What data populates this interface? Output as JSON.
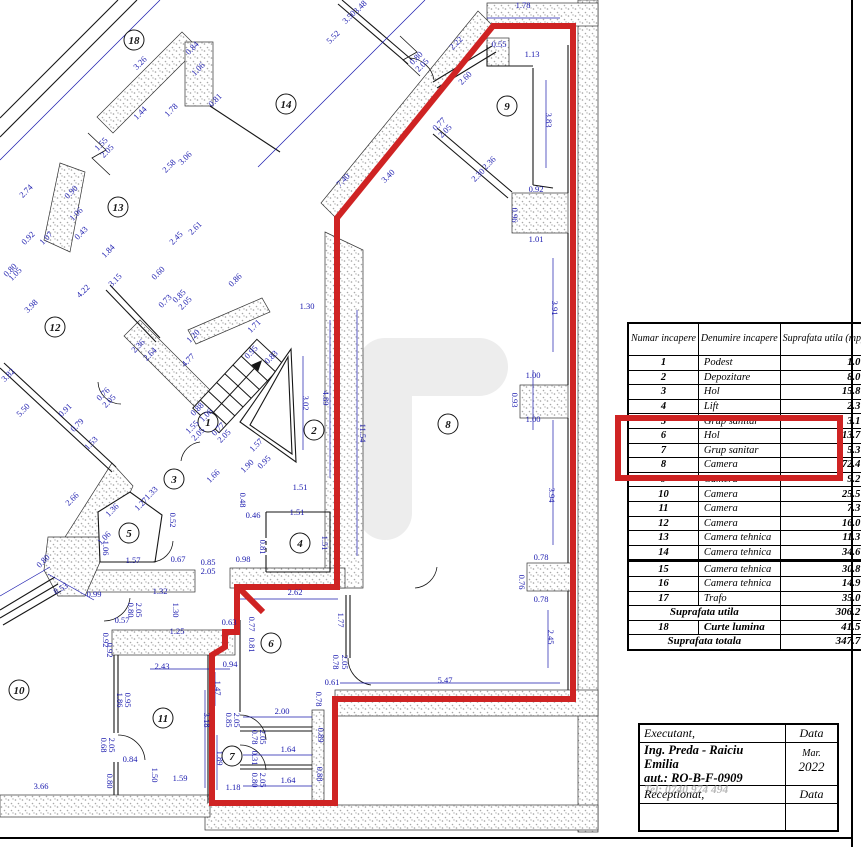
{
  "colors": {
    "dim_blue": "#1a1aae",
    "highlight_red": "#cf2323",
    "wall_line": "#161616",
    "stipple_gray": "#9f9f9f",
    "tel_gray": "#b8b8b8"
  },
  "area_table": {
    "headers": [
      "Numar incapere",
      "Denumire incapere",
      "Suprafata utila (mp)"
    ],
    "rows": [
      [
        "1",
        "Podest",
        "1.0"
      ],
      [
        "2",
        "Depozitare",
        "8.0"
      ],
      [
        "3",
        "Hol",
        "15.8"
      ],
      [
        "4",
        "Lift",
        "2.3"
      ],
      [
        "5",
        "Grup sanitar",
        "3.1"
      ],
      [
        "6",
        "Hol",
        "13.7"
      ],
      [
        "7",
        "Grup sanitar",
        "5.3"
      ],
      [
        "8",
        "Camera",
        "72.4"
      ],
      [
        "9",
        "Camera",
        "9.2"
      ],
      [
        "10",
        "Camera",
        "25.5"
      ],
      [
        "11",
        "Camera",
        "7.3"
      ],
      [
        "12",
        "Camera",
        "16.0"
      ],
      [
        "13",
        "Camera tehnica",
        "11.3"
      ],
      [
        "14",
        "Camera tehnica",
        "34.6"
      ],
      [
        "15",
        "Camera tehnica",
        "30.8"
      ],
      [
        "16",
        "Camera tehnica",
        "14.9"
      ],
      [
        "17",
        "Trafo",
        "35.0"
      ]
    ],
    "heavy_line_after_row": "14",
    "highlighted_rows": [
      "6",
      "7",
      "8",
      "9"
    ],
    "summary": [
      {
        "num": "",
        "label": "Suprafata utila",
        "value": "306.2"
      },
      {
        "num": "18",
        "label": "Curte lumina",
        "value": "41.5"
      },
      {
        "num": "",
        "label": "Suprafata totala",
        "value": "347.7"
      }
    ]
  },
  "title_block": {
    "executant_label": "Executant,",
    "data_label": "Data",
    "name": "Ing. Preda - Raiciu Emilia",
    "aut": "aut.: RO-B-F-0909",
    "tel": "Tel: 0740 974 494",
    "month": "Mar.",
    "year": "2022",
    "receptionat_label": "Receptionat,",
    "data_label2": "Data"
  },
  "plan": {
    "rooms": [
      {
        "n": "1",
        "x": 208,
        "y": 422
      },
      {
        "n": "2",
        "x": 314,
        "y": 430
      },
      {
        "n": "3",
        "x": 174,
        "y": 479
      },
      {
        "n": "4",
        "x": 300,
        "y": 543
      },
      {
        "n": "5",
        "x": 129,
        "y": 533
      },
      {
        "n": "6",
        "x": 271,
        "y": 643
      },
      {
        "n": "7",
        "x": 232,
        "y": 756
      },
      {
        "n": "8",
        "x": 448,
        "y": 424
      },
      {
        "n": "9",
        "x": 507,
        "y": 106
      },
      {
        "n": "10",
        "x": 19,
        "y": 690
      },
      {
        "n": "11",
        "x": 163,
        "y": 718
      },
      {
        "n": "12",
        "x": 55,
        "y": 327
      },
      {
        "n": "13",
        "x": 118,
        "y": 207
      },
      {
        "n": "14",
        "x": 286,
        "y": 104
      },
      {
        "n": "18",
        "x": 134,
        "y": 40
      }
    ],
    "dims": [
      {
        "t": "3.26",
        "x": 142,
        "y": 65,
        "r": -45
      },
      {
        "t": "0.84",
        "x": 194,
        "y": 50,
        "r": -45
      },
      {
        "t": "1.06",
        "x": 200,
        "y": 71,
        "r": -45
      },
      {
        "t": "0.81",
        "x": 217,
        "y": 102,
        "r": -45
      },
      {
        "t": "1.44",
        "x": 142,
        "y": 115,
        "r": -45
      },
      {
        "t": "1.78",
        "x": 173,
        "y": 112,
        "r": -45
      },
      {
        "t": "2.58",
        "x": 171,
        "y": 168,
        "r": -45
      },
      {
        "t": "3.06",
        "x": 187,
        "y": 160,
        "r": -45
      },
      {
        "t": "2.74",
        "x": 28,
        "y": 193,
        "r": -45
      },
      {
        "t": "0.90",
        "x": 73,
        "y": 194,
        "r": -45
      },
      {
        "t": "1.06",
        "x": 78,
        "y": 216,
        "r": -45
      },
      {
        "t": "2.61",
        "x": 197,
        "y": 230,
        "r": -45
      },
      {
        "t": "2.45",
        "x": 178,
        "y": 240,
        "r": -45
      },
      {
        "t": "1.07",
        "x": 48,
        "y": 240,
        "r": -45
      },
      {
        "t": "0.92",
        "x": 30,
        "y": 240,
        "r": -45
      },
      {
        "t": "0.43",
        "x": 83,
        "y": 235,
        "r": -45
      },
      {
        "t": "1.84",
        "x": 110,
        "y": 253,
        "r": -45
      },
      {
        "t": "0.60",
        "x": 160,
        "y": 275,
        "r": -45
      },
      {
        "t": "3.15",
        "x": 117,
        "y": 282,
        "r": -45
      },
      {
        "t": "0.86",
        "x": 237,
        "y": 282,
        "r": -45
      },
      {
        "t": "0.80",
        "x": 12,
        "y": 272,
        "r": -45
      },
      {
        "t": "1.05",
        "x": 17,
        "y": 276,
        "r": -45
      },
      {
        "t": "4.22",
        "x": 85,
        "y": 293,
        "r": -45
      },
      {
        "t": "3.98",
        "x": 33,
        "y": 308,
        "r": -45
      },
      {
        "t": "2.36",
        "x": 140,
        "y": 348,
        "r": -45
      },
      {
        "t": "2.64",
        "x": 152,
        "y": 356,
        "r": -45
      },
      {
        "t": "1.20",
        "x": 195,
        "y": 338,
        "r": -45
      },
      {
        "t": "4.77",
        "x": 190,
        "y": 362,
        "r": -45
      },
      {
        "t": "0.73",
        "x": 167,
        "y": 303,
        "r": -45
      },
      {
        "t": "3.82",
        "x": 10,
        "y": 377,
        "r": -45
      },
      {
        "t": "5.50",
        "x": 25,
        "y": 412,
        "r": -45
      },
      {
        "t": "0.91",
        "x": 67,
        "y": 412,
        "r": -45
      },
      {
        "t": "0.79",
        "x": 79,
        "y": 427,
        "r": -45
      },
      {
        "t": "1.53",
        "x": 93,
        "y": 445,
        "r": -45
      },
      {
        "t": "2.66",
        "x": 74,
        "y": 501,
        "r": -45
      },
      {
        "t": "1.33",
        "x": 153,
        "y": 495,
        "r": -45
      },
      {
        "t": "1.27",
        "x": 143,
        "y": 506,
        "r": -45
      },
      {
        "t": "1.36",
        "x": 114,
        "y": 512,
        "r": -45
      },
      {
        "t": "1.06",
        "x": 106,
        "y": 540,
        "r": -45
      },
      {
        "t": "0.88",
        "x": 199,
        "y": 411,
        "r": -45
      },
      {
        "t": "1.06",
        "x": 208,
        "y": 417,
        "r": -45
      },
      {
        "t": "1.57",
        "x": 258,
        "y": 447,
        "r": -45
      },
      {
        "t": "1.90",
        "x": 249,
        "y": 468,
        "r": -45
      },
      {
        "t": "0.95",
        "x": 266,
        "y": 464,
        "r": -45
      },
      {
        "t": "1.66",
        "x": 215,
        "y": 478,
        "r": -45
      },
      {
        "t": "1.71",
        "x": 256,
        "y": 328,
        "r": -45
      },
      {
        "t": "0.95",
        "x": 253,
        "y": 354,
        "r": -45
      },
      {
        "t": "0.83",
        "x": 273,
        "y": 359,
        "r": -45
      },
      {
        "t": "2.22",
        "x": 458,
        "y": 45,
        "r": -45
      },
      {
        "t": "2.60",
        "x": 467,
        "y": 80,
        "r": -45
      },
      {
        "t": "3.48",
        "x": 362,
        "y": 9,
        "r": -45
      },
      {
        "t": "3.50",
        "x": 351,
        "y": 19,
        "r": -45
      },
      {
        "t": "5.52",
        "x": 335,
        "y": 39,
        "r": -45
      },
      {
        "t": "2.36",
        "x": 491,
        "y": 165,
        "r": -45
      },
      {
        "t": "2.30",
        "x": 480,
        "y": 177,
        "r": -45
      },
      {
        "t": "7.40",
        "x": 345,
        "y": 182,
        "r": -45
      },
      {
        "t": "3.40",
        "x": 390,
        "y": 178,
        "r": -45
      },
      {
        "t": "0.80",
        "x": 45,
        "y": 563,
        "r": -45
      },
      {
        "t": "8.53",
        "x": 62,
        "y": 591,
        "r": -30
      },
      {
        "t": "1.30",
        "x": 307,
        "y": 309,
        "r": 0
      },
      {
        "t": "1.51",
        "x": 300,
        "y": 490,
        "r": 0
      },
      {
        "t": "0.46",
        "x": 253,
        "y": 518,
        "r": 0
      },
      {
        "t": "1.51",
        "x": 297,
        "y": 515,
        "r": 0
      },
      {
        "t": "0.67",
        "x": 178,
        "y": 562,
        "r": 0
      },
      {
        "t": "0.85",
        "x": 208,
        "y": 565,
        "r": 0
      },
      {
        "t": "2.05",
        "x": 208,
        "y": 574,
        "r": 0
      },
      {
        "t": "0.98",
        "x": 243,
        "y": 562,
        "r": 0
      },
      {
        "t": "1.57",
        "x": 133,
        "y": 563,
        "r": 0
      },
      {
        "t": "1.78",
        "x": 523,
        "y": 8,
        "r": 0
      },
      {
        "t": "0.55",
        "x": 499,
        "y": 47,
        "r": 0
      },
      {
        "t": "1.13",
        "x": 532,
        "y": 57,
        "r": 0
      },
      {
        "t": "0.92",
        "x": 536,
        "y": 192,
        "r": 0
      },
      {
        "t": "1.01",
        "x": 536,
        "y": 242,
        "r": 0
      },
      {
        "t": "1.00",
        "x": 533,
        "y": 378,
        "r": 0
      },
      {
        "t": "1.00",
        "x": 533,
        "y": 422,
        "r": 0
      },
      {
        "t": "0.78",
        "x": 541,
        "y": 560,
        "r": 0
      },
      {
        "t": "0.78",
        "x": 541,
        "y": 602,
        "r": 0
      },
      {
        "t": "5.47",
        "x": 445,
        "y": 683,
        "r": 0
      },
      {
        "t": "0.61",
        "x": 332,
        "y": 685,
        "r": 0
      },
      {
        "t": "2.62",
        "x": 295,
        "y": 595,
        "r": 0
      },
      {
        "t": "0.63",
        "x": 229,
        "y": 625,
        "r": 0
      },
      {
        "t": "0.94",
        "x": 230,
        "y": 667,
        "r": 0
      },
      {
        "t": "2.43",
        "x": 162,
        "y": 669,
        "r": 0
      },
      {
        "t": "1.25",
        "x": 177,
        "y": 634,
        "r": 0
      },
      {
        "t": "1.32",
        "x": 160,
        "y": 594,
        "r": 0
      },
      {
        "t": "0.99",
        "x": 94,
        "y": 597,
        "r": 0
      },
      {
        "t": "0.57",
        "x": 122,
        "y": 623,
        "r": 0
      },
      {
        "t": "2.00",
        "x": 282,
        "y": 714,
        "r": 0
      },
      {
        "t": "1.64",
        "x": 288,
        "y": 752,
        "r": 0
      },
      {
        "t": "1.64",
        "x": 288,
        "y": 783,
        "r": 0
      },
      {
        "t": "1.18",
        "x": 233,
        "y": 790,
        "r": 0
      },
      {
        "t": "0.84",
        "x": 130,
        "y": 762,
        "r": 0
      },
      {
        "t": "1.59",
        "x": 180,
        "y": 781,
        "r": 0
      },
      {
        "t": "3.66",
        "x": 41,
        "y": 789,
        "r": 0
      },
      {
        "t": "3.02",
        "x": 303,
        "y": 403,
        "r": 90
      },
      {
        "t": "4.89",
        "x": 323,
        "y": 398,
        "r": 90
      },
      {
        "t": "11.54",
        "x": 360,
        "y": 433,
        "r": 90
      },
      {
        "t": "3.83",
        "x": 546,
        "y": 120,
        "r": 90
      },
      {
        "t": "0.96",
        "x": 512,
        "y": 215,
        "r": 90
      },
      {
        "t": "3.91",
        "x": 552,
        "y": 308,
        "r": 90
      },
      {
        "t": "0.93",
        "x": 512,
        "y": 400,
        "r": 90
      },
      {
        "t": "3.94",
        "x": 549,
        "y": 495,
        "r": 90
      },
      {
        "t": "0.76",
        "x": 519,
        "y": 582,
        "r": 90
      },
      {
        "t": "2.45",
        "x": 548,
        "y": 637,
        "r": 90
      },
      {
        "t": "1.77",
        "x": 338,
        "y": 620,
        "r": 90
      },
      {
        "t": "0.78",
        "x": 333,
        "y": 662,
        "r": 90
      },
      {
        "t": "2.05",
        "x": 342,
        "y": 662,
        "r": 90
      },
      {
        "t": "0.48",
        "x": 240,
        "y": 500,
        "r": 90
      },
      {
        "t": "0.52",
        "x": 170,
        "y": 520,
        "r": 90
      },
      {
        "t": "0.81",
        "x": 260,
        "y": 547,
        "r": 90
      },
      {
        "t": "1.51",
        "x": 322,
        "y": 543,
        "r": 90
      },
      {
        "t": "0.92",
        "x": 107,
        "y": 650,
        "r": 90
      },
      {
        "t": "1.30",
        "x": 173,
        "y": 610,
        "r": 90
      },
      {
        "t": "0.80",
        "x": 128,
        "y": 610,
        "r": 90
      },
      {
        "t": "2.05",
        "x": 136,
        "y": 610,
        "r": 90
      },
      {
        "t": "1.86",
        "x": 117,
        "y": 700,
        "r": 90
      },
      {
        "t": "0.95",
        "x": 125,
        "y": 700,
        "r": 90
      },
      {
        "t": "3.18",
        "x": 204,
        "y": 720,
        "r": 90
      },
      {
        "t": "1.47",
        "x": 215,
        "y": 688,
        "r": 90
      },
      {
        "t": "1.89",
        "x": 217,
        "y": 758,
        "r": 90
      },
      {
        "t": "0.77",
        "x": 249,
        "y": 624,
        "r": 90
      },
      {
        "t": "0.81",
        "x": 249,
        "y": 645,
        "r": 90
      },
      {
        "t": "0.78",
        "x": 252,
        "y": 737,
        "r": 90
      },
      {
        "t": "2.05",
        "x": 260,
        "y": 737,
        "r": 90
      },
      {
        "t": "0.31",
        "x": 252,
        "y": 758,
        "r": 90
      },
      {
        "t": "0.80",
        "x": 252,
        "y": 780,
        "r": 90
      },
      {
        "t": "2.05",
        "x": 260,
        "y": 780,
        "r": 90
      },
      {
        "t": "0.89",
        "x": 318,
        "y": 735,
        "r": 90
      },
      {
        "t": "0.88",
        "x": 317,
        "y": 774,
        "r": 90
      },
      {
        "t": "0.68",
        "x": 101,
        "y": 745,
        "r": 90
      },
      {
        "t": "2.05",
        "x": 109,
        "y": 745,
        "r": 90
      },
      {
        "t": "0.80",
        "x": 107,
        "y": 781,
        "r": 90
      },
      {
        "t": "1.50",
        "x": 152,
        "y": 775,
        "r": 90
      },
      {
        "t": "1.06",
        "x": 103,
        "y": 548,
        "r": 90
      },
      {
        "t": "0.92",
        "x": 103,
        "y": 640,
        "r": 90
      },
      {
        "t": "0.85",
        "x": 226,
        "y": 720,
        "r": 90
      },
      {
        "t": "2.05",
        "x": 234,
        "y": 720,
        "r": 90
      },
      {
        "t": "0.78",
        "x": 316,
        "y": 699,
        "r": 90
      },
      {
        "t": "1.55",
        "x": 103,
        "y": 146,
        "r": -45
      },
      {
        "t": "2.05",
        "x": 109,
        "y": 153,
        "r": -45
      },
      {
        "t": "1.55",
        "x": 194,
        "y": 429,
        "r": -45
      },
      {
        "t": "2.05",
        "x": 200,
        "y": 436,
        "r": -45
      },
      {
        "t": "0.77",
        "x": 220,
        "y": 431,
        "r": -45
      },
      {
        "t": "2.05",
        "x": 226,
        "y": 438,
        "r": -45
      },
      {
        "t": "0.80",
        "x": 418,
        "y": 60,
        "r": -45
      },
      {
        "t": "2.05",
        "x": 424,
        "y": 67,
        "r": -45
      },
      {
        "t": "0.77",
        "x": 441,
        "y": 126,
        "r": -45
      },
      {
        "t": "2.05",
        "x": 447,
        "y": 133,
        "r": -45
      },
      {
        "t": "0.76",
        "x": 105,
        "y": 396,
        "r": -45
      },
      {
        "t": "2.05",
        "x": 111,
        "y": 403,
        "r": -45
      },
      {
        "t": "0.85",
        "x": 181,
        "y": 298,
        "r": -45
      },
      {
        "t": "2.05",
        "x": 187,
        "y": 305,
        "r": -45
      }
    ]
  }
}
